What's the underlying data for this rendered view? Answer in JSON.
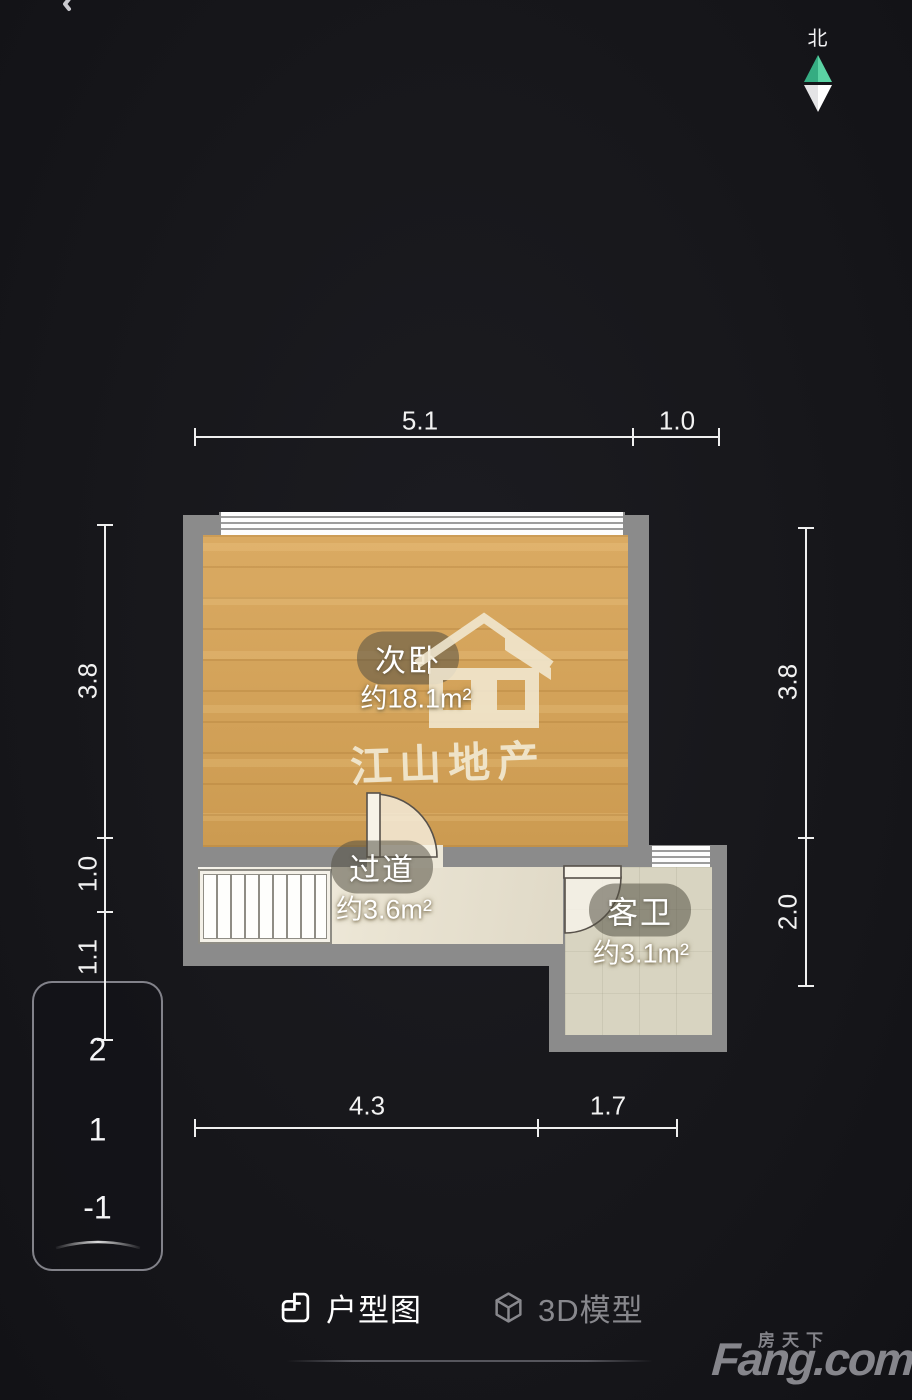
{
  "header": {
    "back_icon": "chevron-left",
    "compass": {
      "label": "北",
      "north_color": "#4cc898"
    }
  },
  "floor_plan": {
    "rooms": [
      {
        "id": "bedroom",
        "name": "次卧",
        "area": "约18.1m²"
      },
      {
        "id": "hallway",
        "name": "过道",
        "area": "约3.6m²"
      },
      {
        "id": "bathroom",
        "name": "客卫",
        "area": "约3.1m²"
      }
    ],
    "watermark": {
      "brand": "江山地产"
    },
    "dimensions": {
      "top": [
        "5.1",
        "1.0"
      ],
      "bottom": [
        "4.3",
        "1.7"
      ],
      "left": [
        "3.8",
        "1.0",
        "1.1"
      ],
      "right": [
        "3.8",
        "2.0"
      ]
    }
  },
  "floor_selector": {
    "floors": [
      "2",
      "1",
      "-1"
    ]
  },
  "tabs": [
    {
      "label": "户型图",
      "active": true
    },
    {
      "label": "3D模型",
      "active": false
    }
  ],
  "footer": {
    "brand_cn": "房天下",
    "brand_en": "Fang.com"
  },
  "colors": {
    "background": "#17171b",
    "wall": "#8b8b8b",
    "wood_floor": "#d7a355",
    "hall_floor": "#ebe5d4",
    "bath_floor": "#d8d4c1",
    "compass_green": "#4cc898",
    "dimension_line": "#efefef",
    "tab_active": "#ffffff",
    "tab_inactive": "#88888d"
  }
}
